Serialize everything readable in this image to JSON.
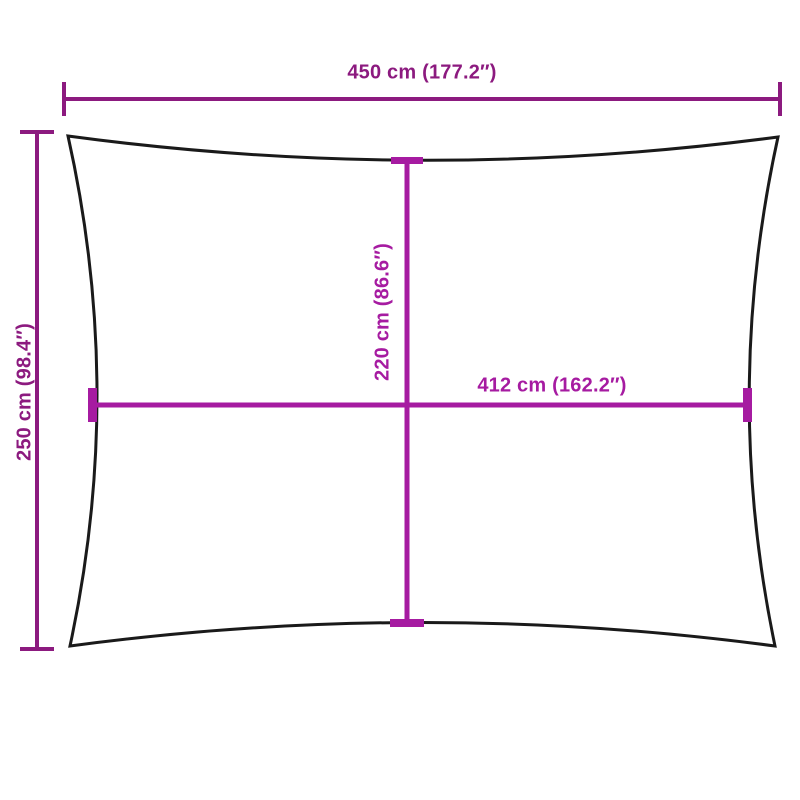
{
  "diagram": {
    "kind": "shade-sail-dimension-diagram",
    "labels": {
      "top_width": "450 cm (177.2″)",
      "left_height": "250 cm (98.4″)",
      "inner_height": "220 cm (86.6″)",
      "inner_width": "412 cm (162.2″)"
    },
    "colors": {
      "outer_dimension": "#8C1A7F",
      "inner_dimension": "#A61BA1",
      "outline": "#1A1A1A",
      "background": "#FFFFFF"
    }
  }
}
